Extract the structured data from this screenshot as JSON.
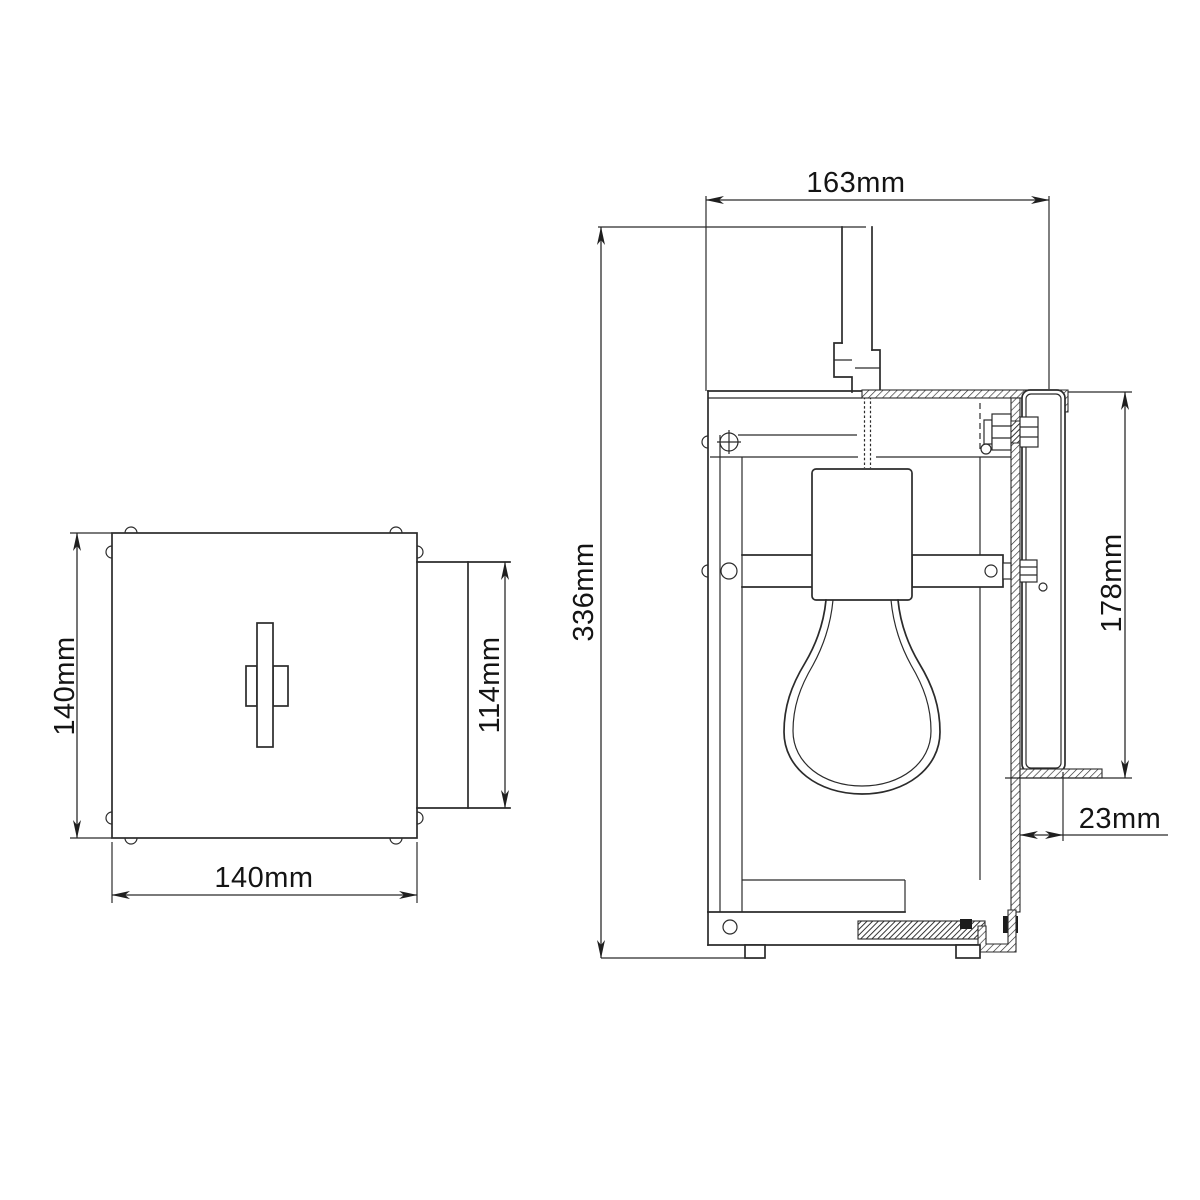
{
  "drawing": {
    "description": "Two-view technical dimension drawing of a wall lantern: plan view of square backplate (left) and side elevation with bulb, bracket and wall plate (right)",
    "background_color": "#ffffff",
    "line_color": "#2b2b2b",
    "text_color": "#141414",
    "unit": "mm"
  },
  "dimensions": {
    "plan_height": {
      "label": "140mm",
      "value": 140,
      "unit": "mm",
      "orientation": "vertical",
      "measures": "backplate height"
    },
    "plan_width": {
      "label": "140mm",
      "value": 140,
      "unit": "mm",
      "orientation": "horizontal",
      "measures": "backplate width"
    },
    "plan_depth": {
      "label": "114mm",
      "value": 114,
      "unit": "mm",
      "orientation": "vertical",
      "measures": "side box height"
    },
    "side_overall_height": {
      "label": "336mm",
      "value": 336,
      "unit": "mm",
      "orientation": "vertical",
      "measures": "overall fixture height"
    },
    "side_top_width": {
      "label": "163mm",
      "value": 163,
      "unit": "mm",
      "orientation": "horizontal",
      "measures": "overall fixture depth"
    },
    "side_glass_height": {
      "label": "178mm",
      "value": 178,
      "unit": "mm",
      "orientation": "vertical",
      "measures": "wall plate height"
    },
    "side_bracket_depth": {
      "label": "23mm",
      "value": 23,
      "unit": "mm",
      "orientation": "horizontal",
      "measures": "wall plate depth"
    }
  }
}
